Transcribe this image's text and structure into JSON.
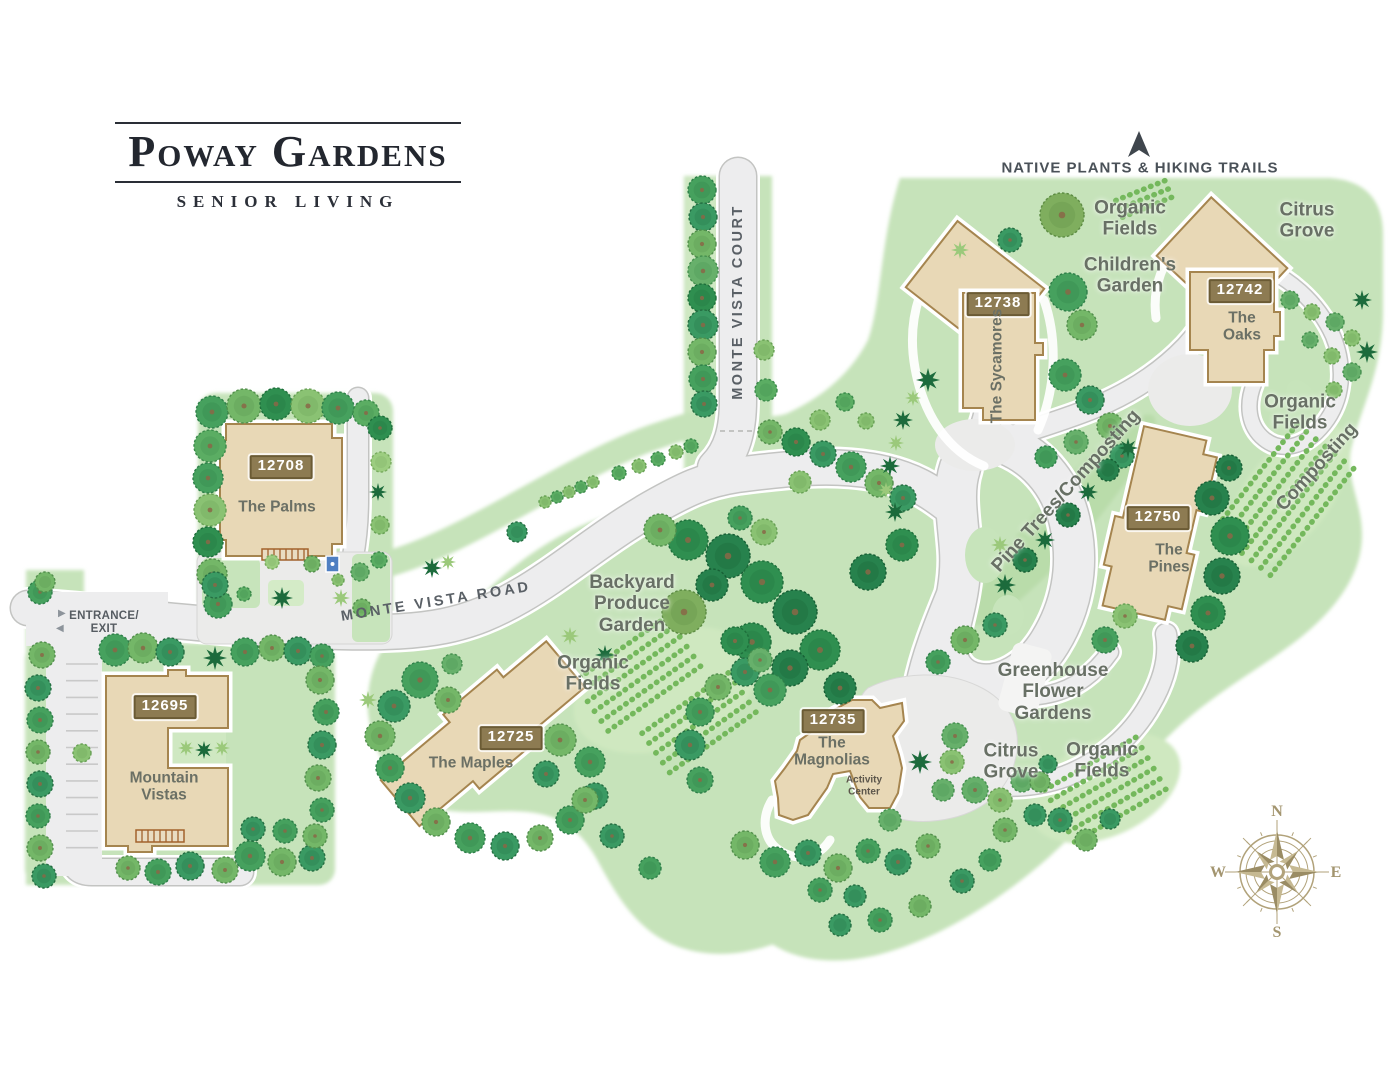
{
  "logo": {
    "title": "Poway Gardens",
    "subtitle": "SENIOR LIVING"
  },
  "trail": {
    "label": "NATIVE PLANTS & HIKING TRAILS",
    "icon": "north-arrow-icon"
  },
  "entrance": {
    "label": "ENTRANCE/ EXIT"
  },
  "roads": {
    "main": "MONTE VISTA ROAD",
    "court": "MONTE VISTA COURT"
  },
  "buildings": {
    "palms": {
      "number": "12708",
      "name": "The Palms"
    },
    "mountain_vistas": {
      "number": "12695",
      "name": "Mountain Vistas"
    },
    "maples": {
      "number": "12725",
      "name": "The Maples"
    },
    "magnolias": {
      "number": "12735",
      "name": "The Magnolias",
      "annex": "Activity Center"
    },
    "sycamores": {
      "number": "12738",
      "name": "The Sycamores"
    },
    "oaks": {
      "number": "12742",
      "name": "The Oaks"
    },
    "pines": {
      "number": "12750",
      "name": "The Pines"
    }
  },
  "areas": {
    "organic_fields_top": "Organic Fields",
    "citrus_grove_top": "Citrus Grove",
    "childrens_garden": "Children's Garden",
    "organic_fields_right": "Organic Fields",
    "composting": "Composting",
    "pine_trees_composting": "Pine Trees/Composting",
    "backyard_produce_garden": "Backyard Produce Garden",
    "organic_fields_center": "Organic Fields",
    "greenhouse_flower_gardens": "Greenhouse Flower Gardens",
    "citrus_grove_bottom": "Citrus Grove",
    "organic_fields_bottom": "Organic Fields"
  },
  "compass": {
    "n": "N",
    "e": "E",
    "s": "S",
    "w": "W"
  },
  "colors": {
    "terrain": "#c6e3ba",
    "road": "#ededee",
    "building_fill": "#e8d8b6",
    "building_outline": "#a5854f",
    "badge": "#8d7b52",
    "label": "#687065",
    "logo_ink": "#23272f",
    "compass": "#b1a27a"
  }
}
